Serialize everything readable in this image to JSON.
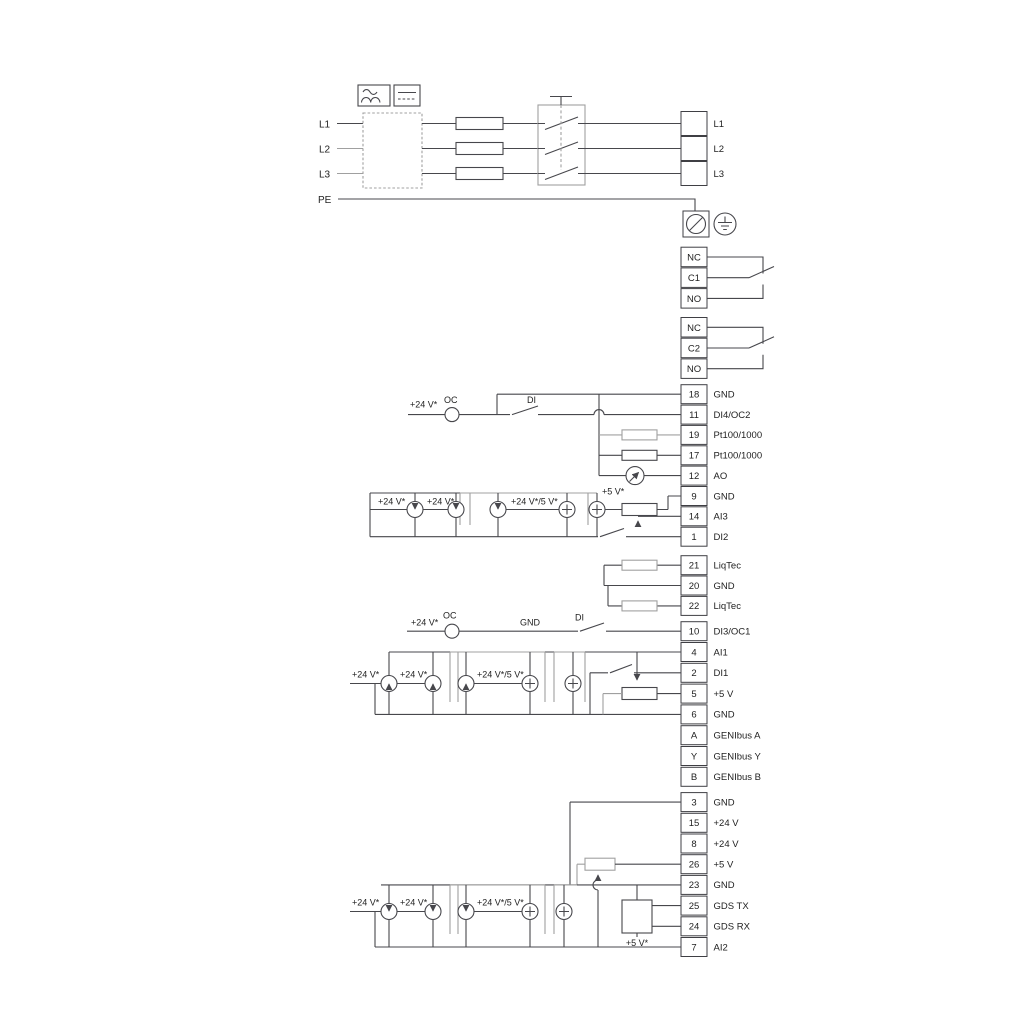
{
  "mains": {
    "left": [
      "L1",
      "L2",
      "L3"
    ],
    "pe": "PE",
    "right": [
      "L1",
      "L2",
      "L3"
    ]
  },
  "relays": [
    {
      "cells": [
        "NC",
        "C1",
        "NO"
      ]
    },
    {
      "cells": [
        "NC",
        "C2",
        "NO"
      ]
    }
  ],
  "blocks": {
    "io1": [
      {
        "no": "18",
        "label": "GND"
      },
      {
        "no": "11",
        "label": "DI4/OC2"
      },
      {
        "no": "19",
        "label": "Pt100/1000"
      },
      {
        "no": "17",
        "label": "Pt100/1000"
      },
      {
        "no": "12",
        "label": "AO"
      },
      {
        "no": "9",
        "label": "GND"
      },
      {
        "no": "14",
        "label": "AI3"
      },
      {
        "no": "1",
        "label": "DI2"
      }
    ],
    "liqtec": [
      {
        "no": "21",
        "label": "LiqTec"
      },
      {
        "no": "20",
        "label": "GND"
      },
      {
        "no": "22",
        "label": "LiqTec"
      }
    ],
    "io2": [
      {
        "no": "10",
        "label": "DI3/OC1"
      },
      {
        "no": "4",
        "label": "AI1"
      },
      {
        "no": "2",
        "label": "DI1"
      },
      {
        "no": "5",
        "label": "+5 V"
      },
      {
        "no": "6",
        "label": "GND"
      },
      {
        "no": "A",
        "label": "GENIbus A"
      },
      {
        "no": "Y",
        "label": "GENIbus Y"
      },
      {
        "no": "B",
        "label": "GENIbus B"
      }
    ],
    "io3": [
      {
        "no": "3",
        "label": "GND"
      },
      {
        "no": "15",
        "label": "+24 V"
      },
      {
        "no": "8",
        "label": "+24 V"
      },
      {
        "no": "26",
        "label": "+5 V"
      },
      {
        "no": "23",
        "label": "GND"
      },
      {
        "no": "25",
        "label": "GDS TX"
      },
      {
        "no": "24",
        "label": "GDS RX"
      },
      {
        "no": "7",
        "label": "AI2"
      }
    ]
  },
  "annotations": {
    "v24": "+24 V*",
    "v24v5": "+24 V*/5 V*",
    "v5": "+5 V*",
    "oc": "OC",
    "di": "DI",
    "gnd": "GND"
  },
  "colors": {
    "line": "#47474c",
    "alt_line": "#a0a0a0",
    "text": "#222222",
    "background": "#ffffff"
  }
}
